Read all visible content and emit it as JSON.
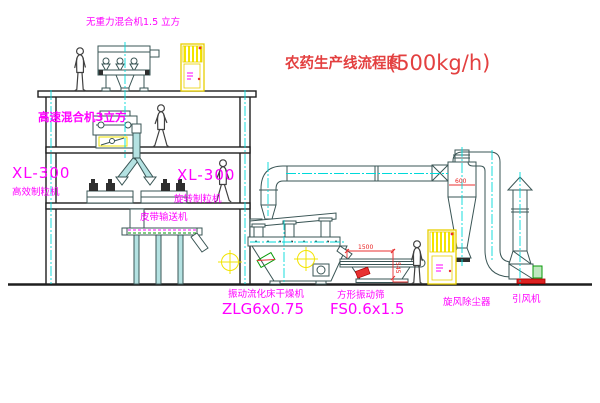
{
  "title": {
    "text": "农药生产线流程图",
    "capacity": "(500kg/h)"
  },
  "equipment": {
    "gravity_mixer": {
      "label": "无重力混合机1.5 立方"
    },
    "high_speed_mixer": {
      "label": "高速混合机3立方"
    },
    "granulator_left": {
      "model": "XL-300",
      "name": "高效制粒机"
    },
    "granulator_right": {
      "model": "XL-300",
      "name": "旋转制粒机"
    },
    "belt_conveyor": {
      "label": "皮带输送机"
    },
    "fluid_bed_dryer": {
      "name": "振动流化床干燥机",
      "model": "ZLG6x0.75"
    },
    "vibrating_screen": {
      "name": "方形振动筛",
      "model": "FS0.6x1.5"
    },
    "cyclone": {
      "name": "旋风除尘器",
      "dim": "600"
    },
    "fan": {
      "name": "引风机"
    }
  },
  "dimensions": {
    "screen_length": "1500",
    "screen_height": "545"
  },
  "colors": {
    "line": "#3a5555",
    "centerline": "#00d9d9",
    "label": "#ff00ff",
    "title": "#e34040",
    "cabinet": "#f2e400",
    "alert": "#e83030",
    "motor_green": "#089a08"
  }
}
